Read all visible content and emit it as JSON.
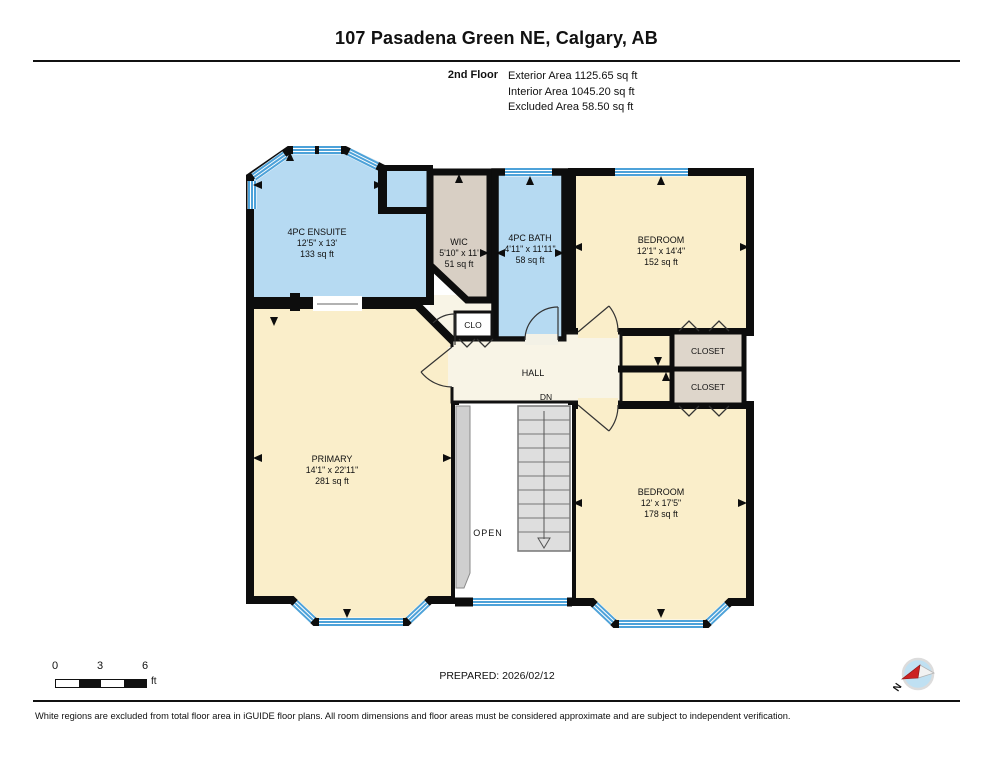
{
  "header": {
    "title": "107 Pasadena Green NE, Calgary, AB",
    "floor_label": "2nd Floor",
    "area_lines": [
      "Exterior Area 1125.65 sq ft",
      "Interior Area 1045.20 sq ft",
      "Excluded Area 58.50 sq ft"
    ]
  },
  "plan": {
    "rooms": [
      {
        "id": "ensuite",
        "name": "4PC ENSUITE",
        "dims": "12'5\" x 13'",
        "area": "133 sq ft"
      },
      {
        "id": "wic",
        "name": "WIC",
        "dims": "5'10\" x 11'",
        "area": "51 sq ft"
      },
      {
        "id": "bath",
        "name": "4PC BATH",
        "dims": "4'11\" x 11'11\"",
        "area": "58 sq ft"
      },
      {
        "id": "bedroom-top",
        "name": "BEDROOM",
        "dims": "12'1\" x 14'4\"",
        "area": "152 sq ft"
      },
      {
        "id": "primary",
        "name": "PRIMARY",
        "dims": "14'1\" x 22'11\"",
        "area": "281 sq ft"
      },
      {
        "id": "bedroom-bottom",
        "name": "BEDROOM",
        "dims": "12' x 17'5\"",
        "area": "178 sq ft"
      }
    ],
    "labels": {
      "clo": "CLO",
      "hall": "HALL",
      "dn": "DN",
      "open": "OPEN",
      "closet_a": "CLOSET",
      "closet_b": "CLOSET"
    }
  },
  "footer": {
    "scale_ticks": [
      "0",
      "3",
      "6"
    ],
    "scale_unit": "ft",
    "prepared": "PREPARED: 2026/02/12",
    "compass_label": "N",
    "disclaimer": "White regions are excluded from total floor area in iGUIDE floor plans. All room dimensions and floor areas must be considered approximate and are subject to independent verification."
  },
  "colors": {
    "wall": "#0d0d0d",
    "room_blue": "#b6daf2",
    "room_cream": "#faeeca",
    "hall_cream": "#f8f4e6",
    "wic_tan": "#d8cfc4",
    "closet_tan": "#ded6cb",
    "stairs_grey": "#dedede",
    "window_blue": "#4da2d9",
    "compass_red": "#cc2222",
    "compass_blue": "#bfe0f2"
  }
}
